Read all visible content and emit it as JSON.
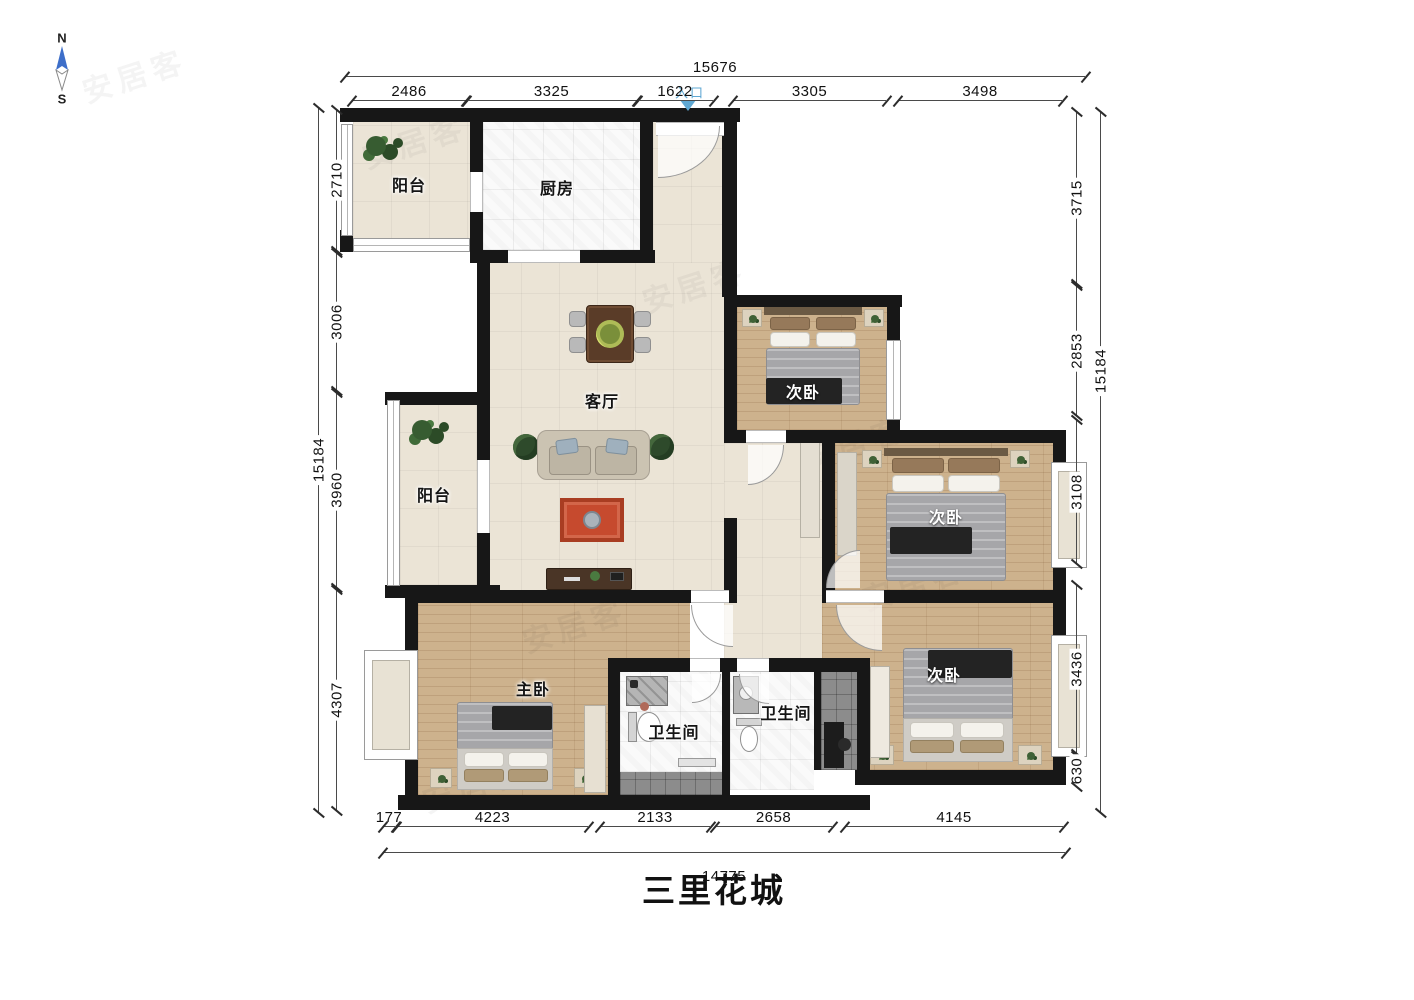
{
  "title": "三里花城",
  "compass": {
    "n": "N",
    "s": "S"
  },
  "entrance": {
    "label": "入口"
  },
  "watermark": "安居客",
  "rooms": {
    "balcony_top": "阳台",
    "kitchen": "厨房",
    "living": "客厅",
    "balcony_left": "阳台",
    "bedroom1": "次卧",
    "bedroom2": "次卧",
    "bedroom3": "次卧",
    "master": "主卧",
    "bath1": "卫生间",
    "bath2": "卫生间"
  },
  "dimensions": {
    "top": {
      "total": "15676",
      "segments": [
        "2486",
        "3325",
        "1622",
        "3305",
        "3498"
      ]
    },
    "bottom": {
      "total": "14775",
      "segments": [
        "177",
        "4223",
        "2133",
        "2658",
        "4145"
      ]
    },
    "left": {
      "total": "15184",
      "segments": [
        "2710",
        "3006",
        "3960",
        "4307"
      ]
    },
    "right": {
      "total": "15184",
      "segments": [
        "3715",
        "2853",
        "3108",
        "3436",
        "630"
      ]
    }
  },
  "colors": {
    "wall": "#171717",
    "floor_tile_beige": "#ebe4d6",
    "floor_wood": "#cdb28d",
    "floor_tile_white": "#fafafa",
    "floor_tile_dark": "#8c8c8c",
    "rug": "#c64a2e",
    "entrance_marker": "#5fa8d3",
    "compass_north": "#3d6ec9",
    "dim_text": "#111111"
  }
}
